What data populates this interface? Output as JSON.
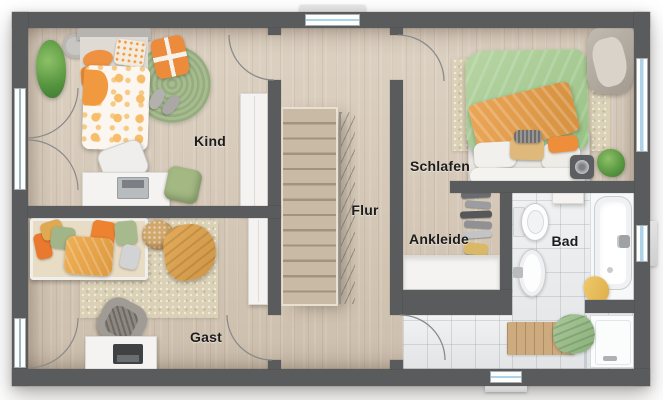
{
  "type": "floor-plan-rendering",
  "rooms": [
    {
      "id": "kind",
      "label": "Kind"
    },
    {
      "id": "flur",
      "label": "Flur"
    },
    {
      "id": "schlafen",
      "label": "Schlafen"
    },
    {
      "id": "ankleide",
      "label": "Ankleide"
    },
    {
      "id": "bad",
      "label": "Bad"
    },
    {
      "id": "gast",
      "label": "Gast"
    }
  ],
  "colors": {
    "wall": "#5a5b5d",
    "wood": "#d8cbba",
    "tile": "#e2e4e6",
    "rug_green": "#a6bc8f",
    "rug_beige": "#dbd1b6",
    "accent_orange": "#ec8b3c",
    "accent_green": "#a4bd8e",
    "glass": "#aed3e8",
    "fixture": "#f7f8f8",
    "label": "#1c1c1c"
  }
}
